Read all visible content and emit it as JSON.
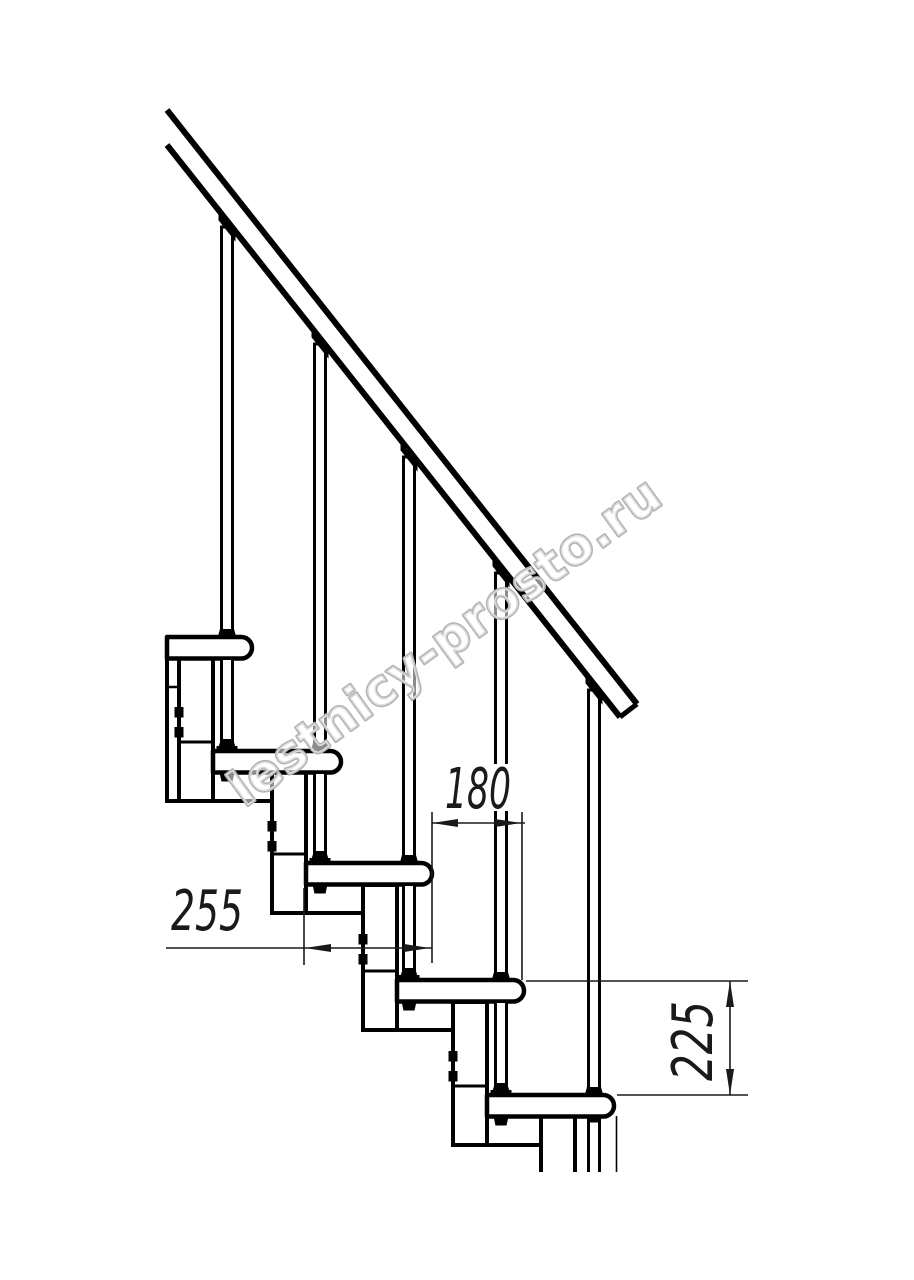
{
  "watermark": {
    "text": "lestnicy-prosto.ru",
    "outline_color": "#b3b3b3",
    "fill_color": "rgba(255,255,255,0.55)"
  },
  "dimensions": {
    "run": {
      "label": "180"
    },
    "tread_depth": {
      "label": "255"
    },
    "riser": {
      "label": "225"
    }
  },
  "drawing": {
    "canvas": {
      "w": 914,
      "h": 1280
    },
    "ink": "#000000",
    "dim_ink": "#1a1a1a",
    "rail": {
      "upper": [
        167,
        110,
        637,
        704
      ],
      "lower": [
        167,
        145,
        620,
        717
      ],
      "cap": [
        637,
        704,
        620,
        717
      ],
      "slope": 1.263
    },
    "tread_thickness": 21.5,
    "rod_width": 11,
    "treads": [
      {
        "top": 637,
        "left": 167,
        "nose": 252
      },
      {
        "top": 751,
        "left": 213,
        "nose": 341
      },
      {
        "top": 863,
        "left": 306,
        "nose": 432
      },
      {
        "top": 980,
        "left": 397,
        "nose": 524
      },
      {
        "top": 1095,
        "left": 487,
        "nose": 614
      }
    ],
    "rods": [
      {
        "x": 227,
        "cap_y": 223
      },
      {
        "x": 320,
        "cap_y": 340
      },
      {
        "x": 409,
        "cap_y": 453
      },
      {
        "x": 501,
        "cap_y": 569
      },
      {
        "x": 594,
        "cap_y": 686
      }
    ],
    "boxes": [
      {
        "x1": 179,
        "y1": 658,
        "x2": 213,
        "y2": 801,
        "divider": 742,
        "bolts": [
          707,
          727
        ]
      },
      {
        "x1": 272,
        "y1": 772,
        "x2": 306,
        "y2": 913,
        "divider": 854,
        "bolts": [
          821,
          841
        ]
      },
      {
        "x1": 363,
        "y1": 885,
        "x2": 397,
        "y2": 1030,
        "divider": 971,
        "bolts": [
          934,
          954
        ]
      },
      {
        "x1": 453,
        "y1": 1002,
        "x2": 487,
        "y2": 1145,
        "divider": 1086,
        "bolts": [
          1051,
          1071
        ]
      },
      {
        "x1": 541,
        "y1": 1116,
        "x2": 575,
        "y2": 1172,
        "open_bottom": true
      }
    ],
    "left_plate": {
      "x1": 167,
      "y1": 658,
      "x2": 179,
      "y2": 801,
      "tick_y": 687
    },
    "connectors": [
      [
        167,
        801,
        272
      ],
      [
        272,
        913,
        363
      ],
      [
        363,
        1030,
        453
      ],
      [
        453,
        1145,
        541
      ]
    ],
    "below_last": {
      "rod_lines": [
        588.5,
        599.5
      ],
      "thin_line": 616.5,
      "top": 1116,
      "bottom": 1172
    },
    "dims": {
      "d180": {
        "y": 823,
        "x1": 432,
        "x2": 525,
        "tips": [
          432,
          521
        ],
        "text_c": [
          478,
          789
        ],
        "bg": [
          444,
          764,
          68,
          47
        ],
        "ext": [
          [
            432,
            812,
            432,
            963
          ],
          [
            522,
            812,
            522,
            980
          ]
        ]
      },
      "d255": {
        "y": 948,
        "x1": 166,
        "x2": 432,
        "tips": [
          305,
          430
        ],
        "text_c": [
          207,
          911
        ],
        "bg": [
          170,
          883,
          76,
          52
        ],
        "ext": [
          [
            304,
            888,
            304,
            965
          ]
        ]
      },
      "d225": {
        "x": 730,
        "y1": 981,
        "y2": 1095,
        "tips": [
          981,
          1095
        ],
        "text_c": [
          693,
          1041
        ],
        "bg": [
          664,
          996,
          56,
          90
        ],
        "rotated": true,
        "ext": [
          [
            526,
            981,
            748,
            981
          ],
          [
            617,
            1095,
            748,
            1095
          ]
        ]
      }
    }
  }
}
